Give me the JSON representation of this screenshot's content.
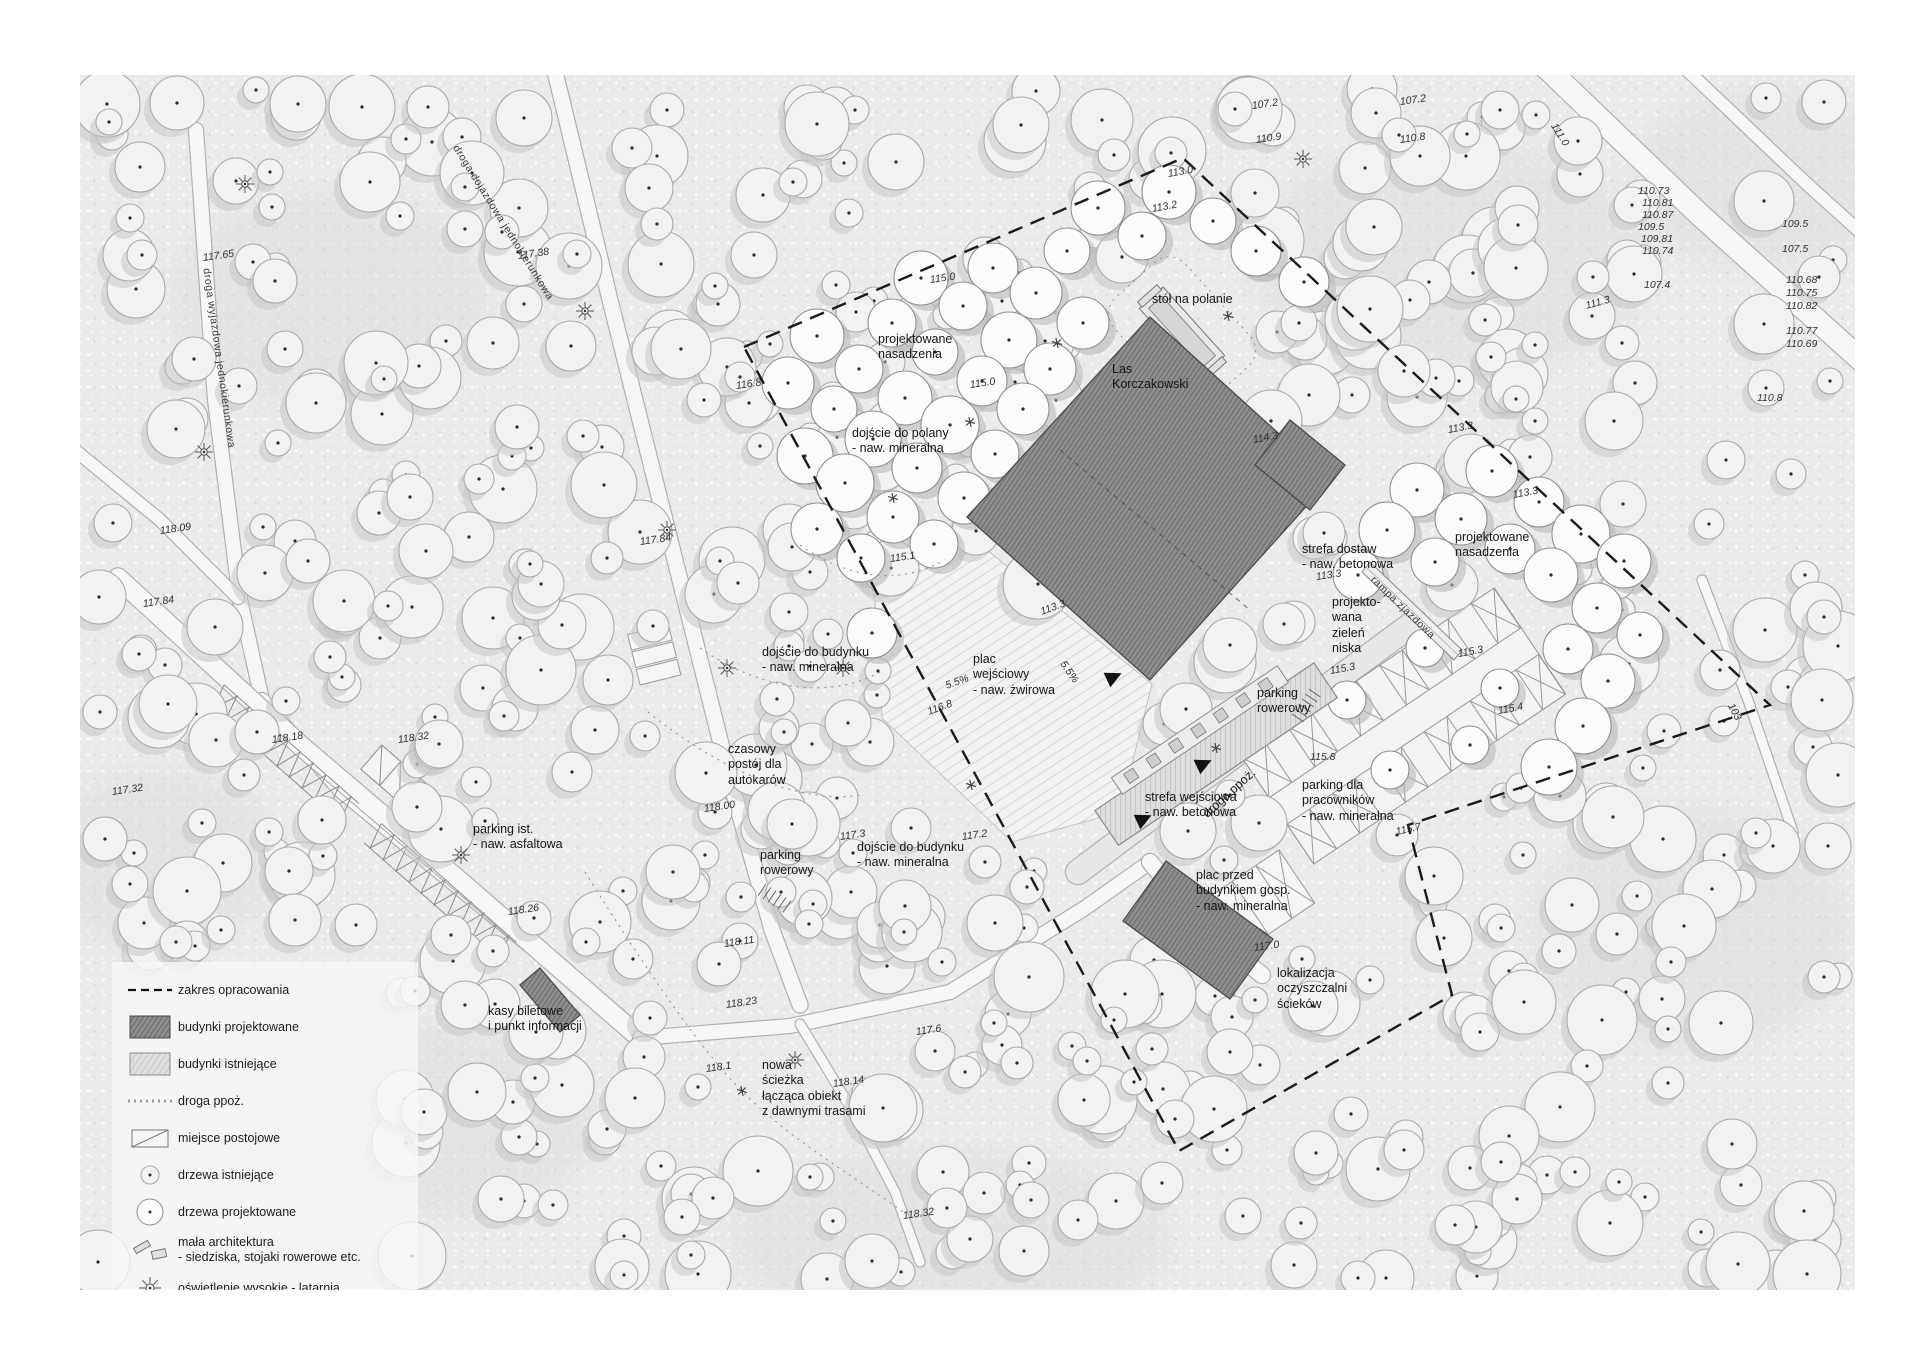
{
  "legend": {
    "items": [
      {
        "icon": "boundary-dashed-line",
        "label": "zakres opracowania"
      },
      {
        "icon": "proposed-building-swatch",
        "label": "budynki projektowane"
      },
      {
        "icon": "existing-building-swatch",
        "label": "budynki istniejące"
      },
      {
        "icon": "fire-road-line",
        "label": "droga ppoż."
      },
      {
        "icon": "parking-space",
        "label": "miejsce postojowe"
      },
      {
        "icon": "existing-tree",
        "label": "drzewa istniejące"
      },
      {
        "icon": "proposed-tree",
        "label": "drzewa projektowane"
      },
      {
        "icon": "street-furniture",
        "label": "mała architektura\n- siedziska, stojaki rowerowe etc."
      },
      {
        "icon": "high-lighting",
        "label": "oświetlenie wysokie - latarnia"
      },
      {
        "icon": "low-lighting",
        "label": "oświetlenie niskie"
      }
    ]
  },
  "colors": {
    "sheet": "#eaeaea",
    "proposed_building": "#8f8f8f",
    "existing_building": "#dedede",
    "boundary": "#1a1a1a",
    "road_fill": "#f7f7f7",
    "road_edge": "#b0b0b0"
  },
  "labels": [
    {
      "t": "droga dojazdowa jednokierunkowa",
      "x": 455,
      "y": 140,
      "r": 58,
      "k": "r"
    },
    {
      "t": "droga wyjazdowa jednokierunkowa",
      "x": 206,
      "y": 262,
      "r": 82,
      "k": "r"
    },
    {
      "t": "projektowane\nnasadzenia",
      "x": 878,
      "y": 332,
      "r": 0,
      "k": "n"
    },
    {
      "t": "stół na polanie",
      "x": 1152,
      "y": 292,
      "r": 0,
      "k": "n"
    },
    {
      "t": "Las\nKorczakowski",
      "x": 1112,
      "y": 362,
      "r": 0,
      "k": "n"
    },
    {
      "t": "dojście do polany\n- naw. mineralna",
      "x": 852,
      "y": 426,
      "r": 0,
      "k": "n"
    },
    {
      "t": "parking ist.\n- naw. asfaltowa",
      "x": 473,
      "y": 822,
      "r": 0,
      "k": "n"
    },
    {
      "t": "kasy biletowe\ni punkt informacji",
      "x": 488,
      "y": 1004,
      "r": 0,
      "k": "n"
    },
    {
      "t": "nowa\nścieżka\nłącząca obiekt\nz dawnymi trasami",
      "x": 762,
      "y": 1058,
      "r": 0,
      "k": "n"
    },
    {
      "t": "czasowy\npostój dla\nautokarów",
      "x": 728,
      "y": 742,
      "r": 0,
      "k": "n"
    },
    {
      "t": "parking\nrowerowy",
      "x": 760,
      "y": 848,
      "r": 0,
      "k": "n"
    },
    {
      "t": "dojście do budynku\n- naw. mineralna",
      "x": 857,
      "y": 840,
      "r": 0,
      "k": "n"
    },
    {
      "t": "dojście do budynku\n- naw. mineralna",
      "x": 762,
      "y": 645,
      "r": 0,
      "k": "n"
    },
    {
      "t": "plac\nwejściowy\n- naw. żwirowa",
      "x": 973,
      "y": 652,
      "r": 0,
      "k": "n"
    },
    {
      "t": "strefa wejściowa\n- naw. betonowa",
      "x": 1145,
      "y": 790,
      "r": 0,
      "k": "n"
    },
    {
      "t": "droga ppoż.",
      "x": 1205,
      "y": 808,
      "r": -42,
      "k": "n"
    },
    {
      "t": "parking\nrowerowy",
      "x": 1257,
      "y": 686,
      "r": 0,
      "k": "n"
    },
    {
      "t": "parking dla\npracowników\n- naw. mineralna",
      "x": 1302,
      "y": 778,
      "r": 0,
      "k": "n"
    },
    {
      "t": "plac przed\nbudynkiem gosp.\n- naw. mineralna",
      "x": 1196,
      "y": 868,
      "r": 0,
      "k": "n"
    },
    {
      "t": "lokalizacja\noczyszczalni\nścieków",
      "x": 1277,
      "y": 966,
      "r": 0,
      "k": "n"
    },
    {
      "t": "strefa dostaw\n- naw. betonowa",
      "x": 1302,
      "y": 542,
      "r": 0,
      "k": "n"
    },
    {
      "t": "projekto-\nwana\nzieleń\nniska",
      "x": 1332,
      "y": 595,
      "r": 0,
      "k": "n"
    },
    {
      "t": "rampa zjazdowa",
      "x": 1372,
      "y": 572,
      "r": 44,
      "k": "r"
    },
    {
      "t": "projektowane\nnasadzenia",
      "x": 1455,
      "y": 530,
      "r": 0,
      "k": "n"
    },
    {
      "t": "117.65",
      "x": 203,
      "y": 252,
      "r": -8,
      "k": "e"
    },
    {
      "t": "117.38",
      "x": 518,
      "y": 250,
      "r": -8,
      "k": "e"
    },
    {
      "t": "118.09",
      "x": 160,
      "y": 525,
      "r": -8,
      "k": "e"
    },
    {
      "t": "117.84",
      "x": 143,
      "y": 598,
      "r": -8,
      "k": "e"
    },
    {
      "t": "117.32",
      "x": 112,
      "y": 786,
      "r": -8,
      "k": "e"
    },
    {
      "t": "118.18",
      "x": 272,
      "y": 734,
      "r": -8,
      "k": "e"
    },
    {
      "t": "118.32",
      "x": 398,
      "y": 734,
      "r": -8,
      "k": "e"
    },
    {
      "t": "118.26",
      "x": 508,
      "y": 906,
      "r": -8,
      "k": "e"
    },
    {
      "t": "118.11",
      "x": 724,
      "y": 938,
      "r": -8,
      "k": "e"
    },
    {
      "t": "118.23",
      "x": 726,
      "y": 999,
      "r": -8,
      "k": "e"
    },
    {
      "t": "117.6",
      "x": 916,
      "y": 1026,
      "r": -8,
      "k": "e"
    },
    {
      "t": "118.1",
      "x": 706,
      "y": 1063,
      "r": -8,
      "k": "e"
    },
    {
      "t": "118.14",
      "x": 833,
      "y": 1078,
      "r": -8,
      "k": "e"
    },
    {
      "t": "118.32",
      "x": 903,
      "y": 1210,
      "r": -8,
      "k": "e"
    },
    {
      "t": "118.00",
      "x": 704,
      "y": 803,
      "r": -8,
      "k": "e"
    },
    {
      "t": "117.84",
      "x": 640,
      "y": 536,
      "r": -8,
      "k": "e"
    },
    {
      "t": "117.3",
      "x": 840,
      "y": 831,
      "r": -8,
      "k": "e"
    },
    {
      "t": "117.2",
      "x": 962,
      "y": 831,
      "r": -8,
      "k": "e"
    },
    {
      "t": "115.1",
      "x": 890,
      "y": 553,
      "r": -8,
      "k": "e"
    },
    {
      "t": "116.8",
      "x": 736,
      "y": 380,
      "r": -8,
      "k": "e"
    },
    {
      "t": "116.8",
      "x": 928,
      "y": 706,
      "r": -20,
      "k": "e"
    },
    {
      "t": "115.0",
      "x": 930,
      "y": 274,
      "r": -8,
      "k": "e"
    },
    {
      "t": "115.0",
      "x": 970,
      "y": 379,
      "r": -8,
      "k": "e"
    },
    {
      "t": "113.0",
      "x": 1168,
      "y": 168,
      "r": -10,
      "k": "e"
    },
    {
      "t": "113.2",
      "x": 1152,
      "y": 203,
      "r": -10,
      "k": "e"
    },
    {
      "t": "107.2",
      "x": 1252,
      "y": 100,
      "r": -8,
      "k": "e"
    },
    {
      "t": "110.9",
      "x": 1256,
      "y": 134,
      "r": -8,
      "k": "e"
    },
    {
      "t": "107.2",
      "x": 1400,
      "y": 96,
      "r": -8,
      "k": "e"
    },
    {
      "t": "110.8",
      "x": 1400,
      "y": 134,
      "r": -8,
      "k": "e"
    },
    {
      "t": "111.0",
      "x": 1553,
      "y": 118,
      "r": 58,
      "k": "e"
    },
    {
      "t": "110.73",
      "x": 1638,
      "y": 185,
      "r": 0,
      "k": "e"
    },
    {
      "t": "110.81",
      "x": 1642,
      "y": 197,
      "r": 0,
      "k": "e"
    },
    {
      "t": "110.87",
      "x": 1642,
      "y": 209,
      "r": 0,
      "k": "e"
    },
    {
      "t": "109.5",
      "x": 1638,
      "y": 221,
      "r": 0,
      "k": "e"
    },
    {
      "t": "109.81",
      "x": 1641,
      "y": 233,
      "r": 0,
      "k": "e"
    },
    {
      "t": "110.74",
      "x": 1642,
      "y": 245,
      "r": 0,
      "k": "e"
    },
    {
      "t": "109.5",
      "x": 1782,
      "y": 218,
      "r": 0,
      "k": "e"
    },
    {
      "t": "107.5",
      "x": 1782,
      "y": 243,
      "r": 0,
      "k": "e"
    },
    {
      "t": "107.4",
      "x": 1644,
      "y": 279,
      "r": 0,
      "k": "e"
    },
    {
      "t": "110.68",
      "x": 1786,
      "y": 274,
      "r": 0,
      "k": "e"
    },
    {
      "t": "110.75",
      "x": 1786,
      "y": 287,
      "r": 0,
      "k": "e"
    },
    {
      "t": "110.82",
      "x": 1786,
      "y": 300,
      "r": 0,
      "k": "e"
    },
    {
      "t": "110.77",
      "x": 1786,
      "y": 325,
      "r": 0,
      "k": "e"
    },
    {
      "t": "110.69",
      "x": 1786,
      "y": 338,
      "r": 0,
      "k": "e"
    },
    {
      "t": "111.3",
      "x": 1586,
      "y": 300,
      "r": -15,
      "k": "e"
    },
    {
      "t": "110.8",
      "x": 1757,
      "y": 392,
      "r": 0,
      "k": "e"
    },
    {
      "t": "114.3",
      "x": 1253,
      "y": 434,
      "r": -10,
      "k": "e"
    },
    {
      "t": "113.3",
      "x": 1448,
      "y": 424,
      "r": -10,
      "k": "e"
    },
    {
      "t": "113.3",
      "x": 1513,
      "y": 489,
      "r": -10,
      "k": "e"
    },
    {
      "t": "113.3",
      "x": 1316,
      "y": 571,
      "r": -8,
      "k": "e"
    },
    {
      "t": "113.3",
      "x": 1041,
      "y": 606,
      "r": -20,
      "k": "e"
    },
    {
      "t": "5.5%",
      "x": 946,
      "y": 680,
      "r": -20,
      "k": "e"
    },
    {
      "t": "5.5%",
      "x": 1062,
      "y": 656,
      "r": 55,
      "k": "e"
    },
    {
      "t": "115.3",
      "x": 1458,
      "y": 648,
      "r": -10,
      "k": "e"
    },
    {
      "t": "115.3",
      "x": 1330,
      "y": 665,
      "r": -10,
      "k": "e"
    },
    {
      "t": "115.4",
      "x": 1498,
      "y": 705,
      "r": -10,
      "k": "e"
    },
    {
      "t": "115.8",
      "x": 1310,
      "y": 751,
      "r": 0,
      "k": "e"
    },
    {
      "t": "115.7",
      "x": 1396,
      "y": 826,
      "r": -12,
      "k": "e"
    },
    {
      "t": "117.0",
      "x": 1254,
      "y": 942,
      "r": -8,
      "k": "e"
    },
    {
      "t": "103",
      "x": 1730,
      "y": 698,
      "r": 62,
      "k": "e"
    }
  ],
  "boundary_path": "M744,347 L1183,158 L1770,705 L1408,825 L1452,995 L1179,1151 Z",
  "roads": [
    {
      "pts": [
        [
          545,
          30
        ],
        [
          610,
          300
        ],
        [
          665,
          520
        ],
        [
          730,
          780
        ],
        [
          772,
          930
        ],
        [
          800,
          1005
        ]
      ],
      "w": 15
    },
    {
      "pts": [
        [
          196,
          130
        ],
        [
          215,
          400
        ],
        [
          240,
          600
        ],
        [
          262,
          700
        ]
      ],
      "w": 14
    },
    {
      "pts": [
        [
          262,
          700
        ],
        [
          340,
          790
        ],
        [
          480,
          905
        ],
        [
          640,
          1035
        ]
      ],
      "w": 14
    },
    {
      "pts": [
        [
          118,
          578
        ],
        [
          300,
          745
        ],
        [
          470,
          890
        ],
        [
          640,
          1038
        ]
      ],
      "w": 19
    },
    {
      "pts": [
        [
          65,
          442
        ],
        [
          160,
          520
        ],
        [
          238,
          598
        ]
      ],
      "w": 12
    },
    {
      "pts": [
        [
          640,
          1038
        ],
        [
          790,
          1026
        ],
        [
          950,
          992
        ],
        [
          1085,
          908
        ],
        [
          1150,
          862
        ]
      ],
      "w": 14
    },
    {
      "pts": [
        [
          800,
          1024
        ],
        [
          852,
          1110
        ],
        [
          895,
          1192
        ],
        [
          920,
          1262
        ]
      ],
      "w": 9
    },
    {
      "pts": [
        [
          1078,
          872
        ],
        [
          1190,
          788
        ],
        [
          1320,
          692
        ],
        [
          1415,
          622
        ]
      ],
      "w": 24,
      "fill": "#e7e7e7"
    },
    {
      "pts": [
        [
          1150,
          862
        ],
        [
          1205,
          928
        ],
        [
          1262,
          975
        ]
      ],
      "w": 16
    },
    {
      "pts": [
        [
          1528,
          50
        ],
        [
          1700,
          215
        ],
        [
          1870,
          368
        ],
        [
          1930,
          405
        ]
      ],
      "w": 22
    },
    {
      "pts": [
        [
          1650,
          35
        ],
        [
          1808,
          185
        ],
        [
          1930,
          295
        ]
      ],
      "w": 12
    },
    {
      "pts": [
        [
          1702,
          580
        ],
        [
          1748,
          700
        ],
        [
          1793,
          832
        ]
      ],
      "w": 9
    }
  ],
  "buildings": {
    "proposed_main": "967,517 1150,317 1330,480 1150,680",
    "proposed_main_ridge": {
      "x1": 1060,
      "y1": 450,
      "x2": 1250,
      "y2": 610
    },
    "proposed_ne": "1290,420 1345,465 1310,510 1255,465",
    "proposed_gosp": "1273,939 1230,999 1123,921 1166,861",
    "proposed_kasy": "580,1015 560,1032 520,985 540,968"
  },
  "existing_strip": {
    "cx": 1210,
    "cy": 745,
    "rot": -34
  },
  "ramp": "1362,572 1370,562 1462,650 1454,660",
  "plaza_poly": "960,528 1152,684 1120,812 1012,842 882,718 874,586",
  "parking_right": {
    "cx": 1404,
    "cy": 726,
    "rot": -34,
    "hw": 152,
    "hh": 64
  },
  "parking_gosp": {
    "cx": 1262,
    "cy": 900,
    "rot": -34
  },
  "table_glade": {
    "cx": 1182,
    "cy": 332,
    "rot": 48
  },
  "symbols": {
    "lanterns": [
      [
        245,
        184
      ],
      [
        585,
        311
      ],
      [
        204,
        452
      ],
      [
        667,
        530
      ],
      [
        727,
        668
      ],
      [
        843,
        668
      ],
      [
        461,
        855
      ],
      [
        795,
        1060
      ],
      [
        1303,
        159
      ]
    ],
    "lowlights": [
      [
        1057,
        343
      ],
      [
        970,
        422
      ],
      [
        893,
        498
      ],
      [
        971,
        785
      ],
      [
        742,
        1091
      ],
      [
        1228,
        316
      ],
      [
        1216,
        748
      ]
    ],
    "arrows": [
      {
        "x": 1107,
        "y": 680,
        "r": -25
      },
      {
        "x": 1197,
        "y": 767,
        "r": -25
      },
      {
        "x": 1137,
        "y": 822,
        "r": -25
      }
    ],
    "bike_racks": [
      {
        "x": 766,
        "y": 884,
        "r": 34
      },
      {
        "x": 1292,
        "y": 714,
        "r": -56
      }
    ]
  },
  "dotted_paths": [
    "M585,872 C640,960 700,1050 742,1091 C790,1140 860,1180 903,1212",
    "M700,648 C760,690 830,700 880,672",
    "M648,712 C720,770 800,805 862,795",
    "M800,545 C850,580 900,585 945,560"
  ],
  "forest": {
    "seed": 20240613,
    "scatter_attempts": 780,
    "r_min": 13,
    "r_max": 35,
    "grid_step": 53,
    "grid_r": 26,
    "grid_angle": 34,
    "grid_origin": [
      744,
      352
    ],
    "grid_regions": [
      [
        [
          748,
          350
        ],
        [
          1180,
          162
        ],
        [
          1320,
          280
        ],
        [
          1150,
          470
        ],
        [
          965,
          500
        ],
        [
          880,
          660
        ],
        [
          790,
          560
        ]
      ],
      [
        [
          1368,
          462
        ],
        [
          1560,
          470
        ],
        [
          1660,
          560
        ],
        [
          1600,
          790
        ],
        [
          1420,
          735
        ],
        [
          1350,
          600
        ]
      ]
    ],
    "clearing": {
      "cx": 1185,
      "cy": 330,
      "r": 85
    }
  },
  "blotches": [
    [
      330,
      300,
      160,
      110
    ],
    [
      1450,
      260,
      200,
      120
    ],
    [
      420,
      1120,
      180,
      100
    ],
    [
      1690,
      930,
      160,
      120
    ],
    [
      950,
      1240,
      220,
      90
    ],
    [
      160,
      860,
      120,
      90
    ],
    [
      1770,
      180,
      140,
      90
    ]
  ]
}
